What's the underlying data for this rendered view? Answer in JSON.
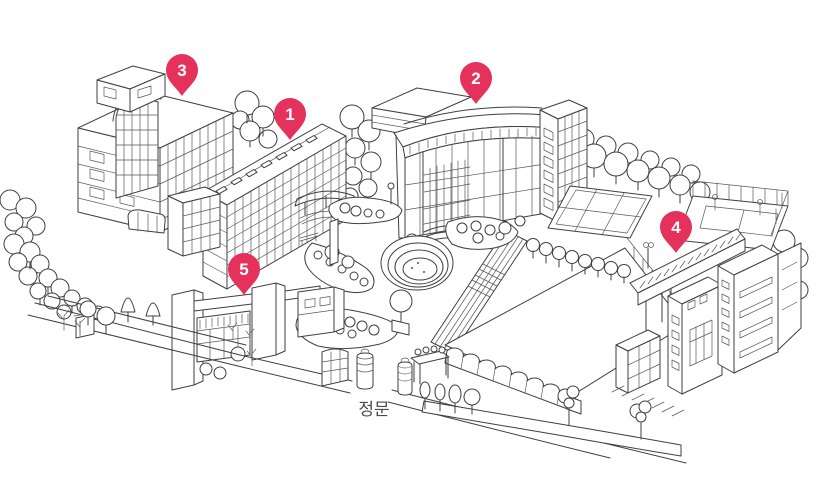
{
  "map": {
    "gate_label": "정문",
    "pins": [
      {
        "number": "1",
        "transform": "translate(290,114)"
      },
      {
        "number": "2",
        "transform": "translate(476,78)"
      },
      {
        "number": "3",
        "transform": "translate(182,70)"
      },
      {
        "number": "4",
        "transform": "translate(676,227)"
      },
      {
        "number": "5",
        "transform": "translate(244,269)"
      }
    ]
  },
  "colors": {
    "pin": "#E5325D",
    "line": "#3F3F3F",
    "label_text": "#4A4A4A",
    "background": "#FFFFFF"
  }
}
